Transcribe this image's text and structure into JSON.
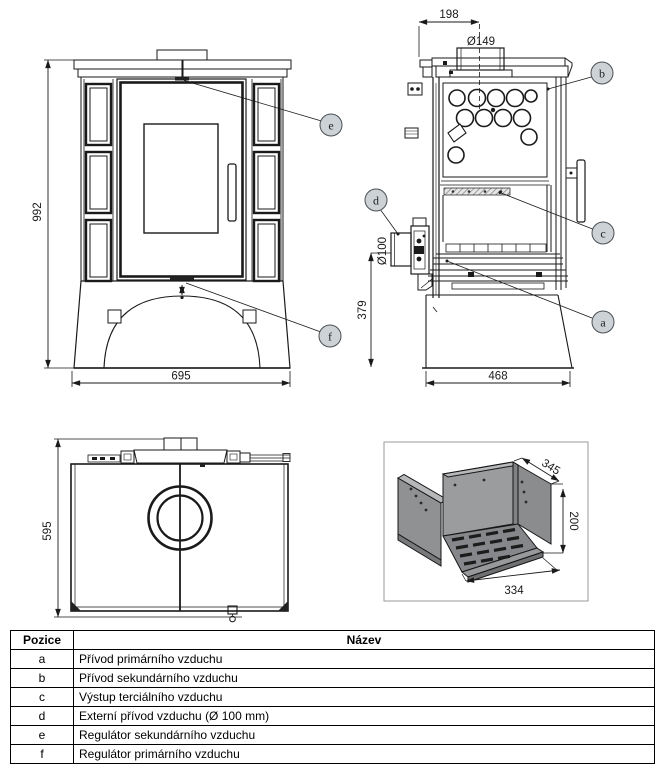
{
  "drawing": {
    "front_view": {
      "height": "992",
      "width": "695",
      "callout_e": "e",
      "callout_f": "f"
    },
    "side_view": {
      "top_offset": "198",
      "flue_diameter": "Ø149",
      "inlet_diameter": "Ø100",
      "inlet_height": "379",
      "depth": "468",
      "callout_a": "a",
      "callout_b": "b",
      "callout_c": "c",
      "callout_d": "d"
    },
    "top_view": {
      "depth": "595"
    },
    "firebox_view": {
      "depth": "345",
      "height": "200",
      "width": "334"
    }
  },
  "table": {
    "headers": {
      "position": "Pozice",
      "name": "Název"
    },
    "rows": [
      {
        "position": "a",
        "name": "Přívod primárního vzduchu"
      },
      {
        "position": "b",
        "name": "Přívod sekundárního vzduchu"
      },
      {
        "position": "c",
        "name": "Výstup terciálního vzduchu"
      },
      {
        "position": "d",
        "name": "Externí přívod vzduchu (Ø 100 mm)"
      },
      {
        "position": "e",
        "name": "Regulátor sekundárního vzduchu"
      },
      {
        "position": "f",
        "name": "Regulátor primárního vzduchu"
      }
    ]
  },
  "colors": {
    "line": "#1a1a1a",
    "callout_fill": "#cdd2d7",
    "firebox_gray": "#8f9193"
  }
}
